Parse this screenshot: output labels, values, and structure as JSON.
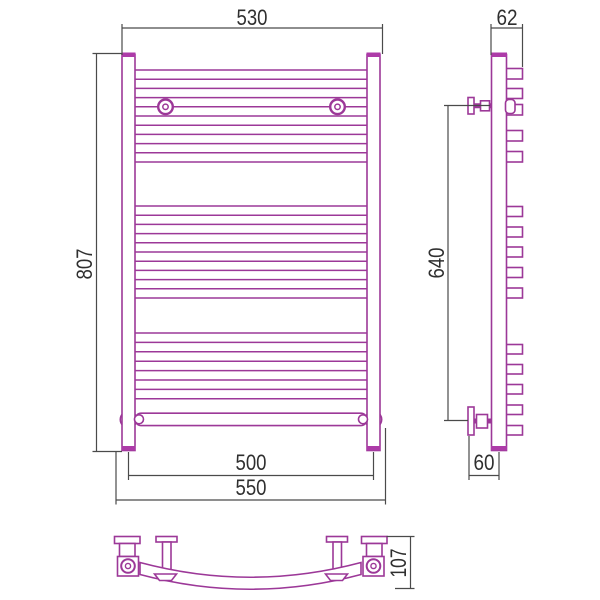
{
  "document": {
    "type": "technical-drawing",
    "subject": "curved heated towel rail, three orthographic projections",
    "colors": {
      "product_outline": "#9c3898",
      "product_cap_fill": "#ad3ba8",
      "dimension_lines": "#4a4a4a",
      "dimension_text": "#2f2f2f",
      "background": "#ffffff"
    },
    "views": {
      "front": "front-view",
      "side": "side-view",
      "top": "top-view"
    },
    "dimensions": {
      "front_width": "530",
      "front_height": "807",
      "side_depth": "62",
      "mounting_height": "640",
      "center_distance": "500",
      "overall_width": "550",
      "wall_offset": "60",
      "top_depth": "107"
    }
  }
}
